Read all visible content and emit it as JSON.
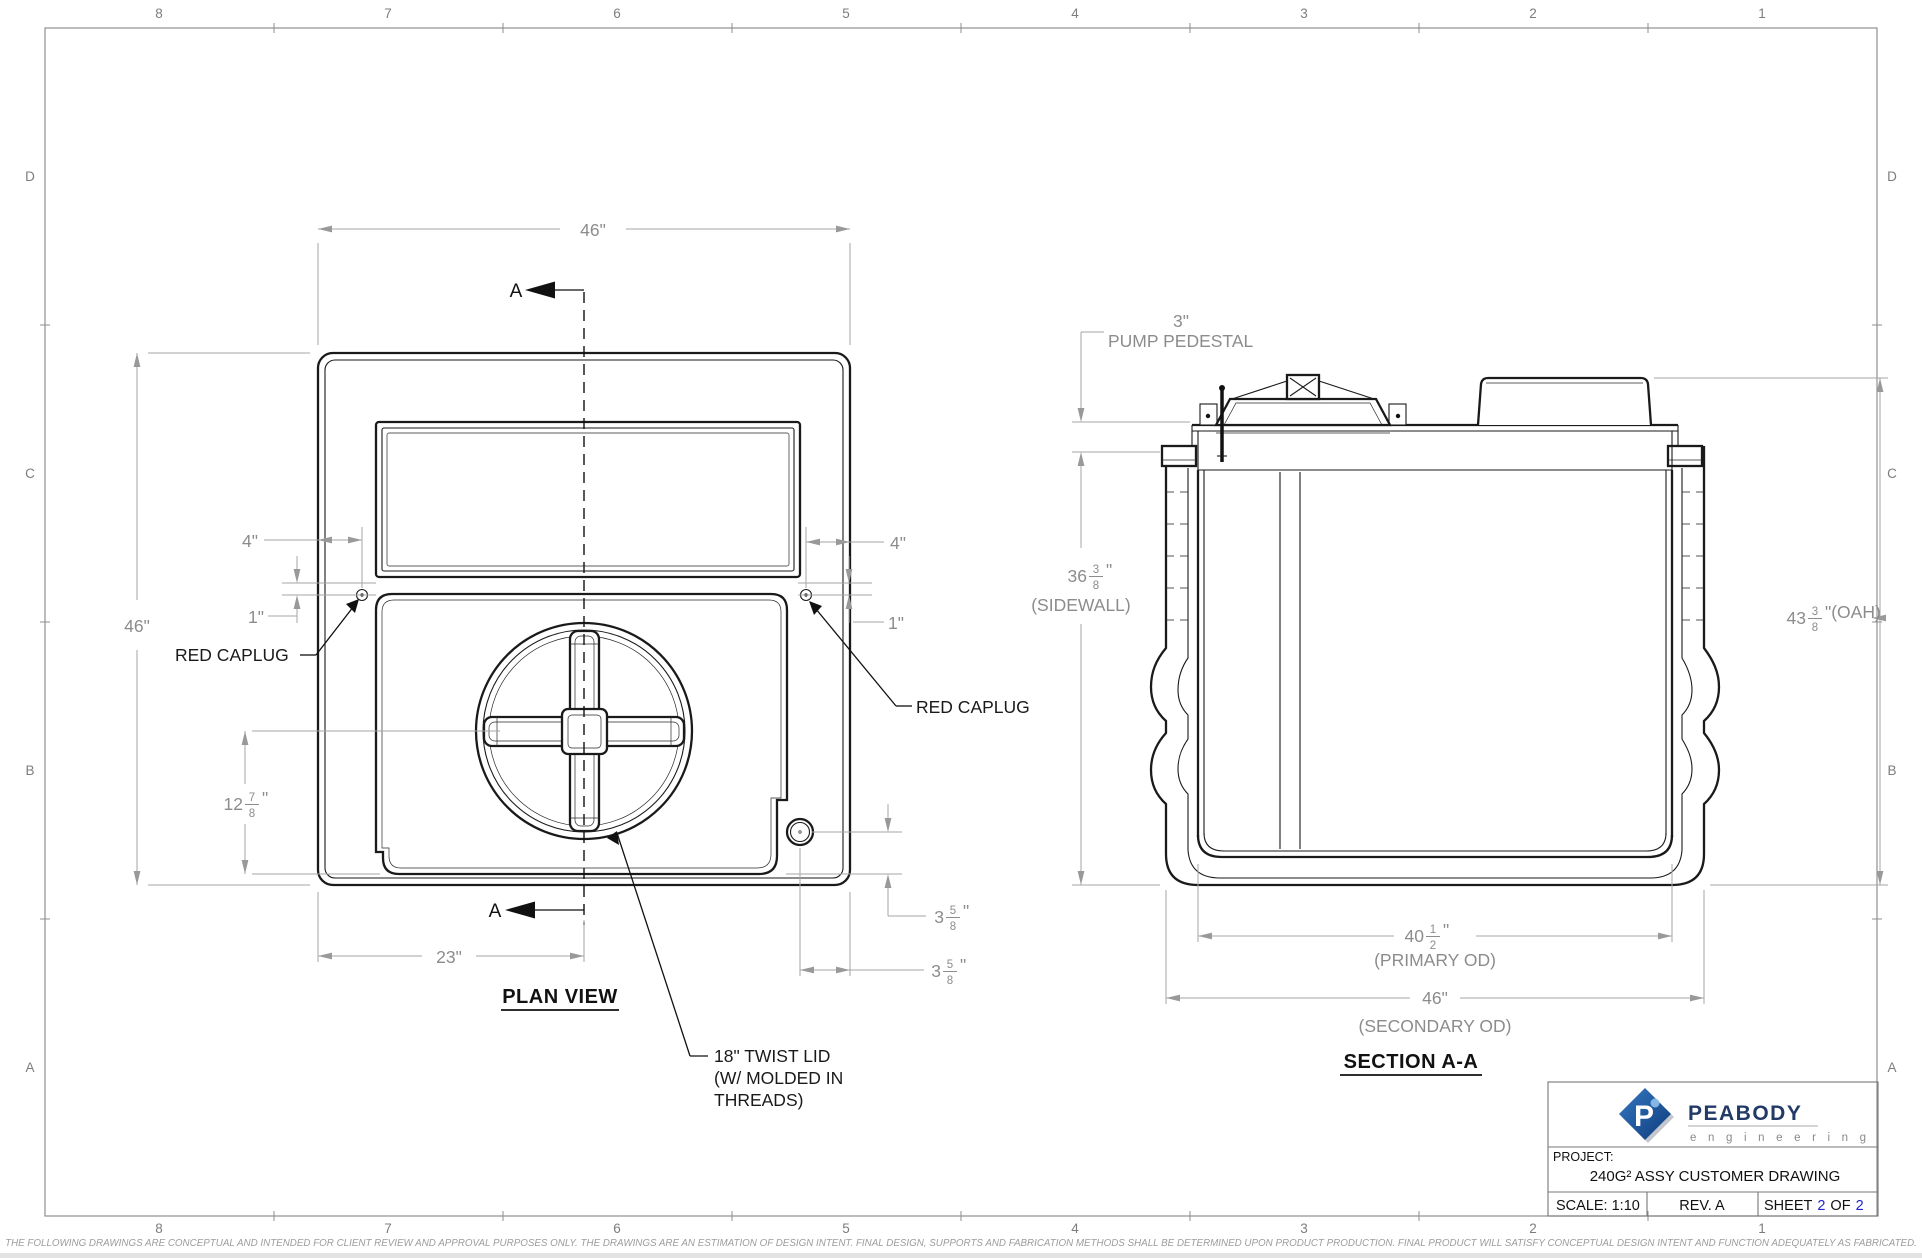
{
  "page": {
    "zones_top": [
      "8",
      "7",
      "6",
      "5",
      "4",
      "3",
      "2",
      "1"
    ],
    "zones_bottom": [
      "8",
      "7",
      "6",
      "5",
      "4",
      "3",
      "2",
      "1"
    ],
    "zones_left": [
      "D",
      "C",
      "B",
      "A"
    ],
    "zones_right": [
      "D",
      "C",
      "B",
      "A"
    ],
    "disclaimer": "THE FOLLOWING DRAWINGS ARE CONCEPTUAL AND INTENDED FOR CLIENT REVIEW AND APPROVAL PURPOSES ONLY. THE DRAWINGS ARE AN ESTIMATION OF DESIGN INTENT. FINAL DESIGN, SUPPORTS AND FABRICATION METHODS SHALL BE DETERMINED UPON PRODUCT PRODUCTION. FINAL PRODUCT WILL SATISFY CONCEPTUAL DESIGN INTENT AND FUNCTION ADEQUATELY AS FABRICATED."
  },
  "plan_view": {
    "title": "PLAN VIEW",
    "section_marker": "A",
    "labels": {
      "red_caplug_left": "RED CAPLUG",
      "red_caplug_right": "RED CAPLUG",
      "twist_lid": [
        "18\" TWIST LID",
        "(W/ MOLDED IN",
        "THREADS)"
      ]
    },
    "dims": {
      "width_top": "46\"",
      "height_left": "46\"",
      "caplug_inset_left": "4\"",
      "caplug_inset_right": "4\"",
      "caplug_drop_left": "1\"",
      "caplug_drop_right": "1\"",
      "lid_offset": "23\"",
      "lid_center": {
        "whole": "12",
        "num": "7",
        "den": "8",
        "suffix": "\""
      },
      "fitting_v": {
        "whole": "3",
        "num": "5",
        "den": "8",
        "suffix": "\""
      },
      "fitting_h": {
        "whole": "3",
        "num": "5",
        "den": "8",
        "suffix": "\""
      }
    }
  },
  "section_view": {
    "title": "SECTION A-A",
    "labels": {
      "pedestal_height": "3\"",
      "pedestal": "PUMP PEDESTAL"
    },
    "dims": {
      "sidewall": {
        "whole": "36",
        "num": "3",
        "den": "8",
        "suffix": "\""
      },
      "sidewall_label": "(SIDEWALL)",
      "oah": {
        "whole": "43",
        "num": "3",
        "den": "8",
        "suffix": "\"(OAH)"
      },
      "primary": {
        "whole": "40",
        "num": "1",
        "den": "2",
        "suffix": "\""
      },
      "primary_label": "(PRIMARY OD)",
      "secondary": "46\"",
      "secondary_label": "(SECONDARY OD)"
    }
  },
  "title_block": {
    "logo_letter": "P",
    "brand": "PEABODY",
    "brand_sub": "e n g i n e e r i n g",
    "project_label": "PROJECT:",
    "project_name": "240G² ASSY CUSTOMER DRAWING",
    "scale": "SCALE: 1:10",
    "rev": "REV. A",
    "sheet_prefix": "SHEET",
    "sheet_number": "2",
    "sheet_of": "OF",
    "sheet_total": "2"
  },
  "colors": {
    "accent_blue": "#2323cc",
    "logo_blue": "#1c4f9c",
    "line_black": "#1a1a1a",
    "dim_gray": "#8c8c8c"
  }
}
